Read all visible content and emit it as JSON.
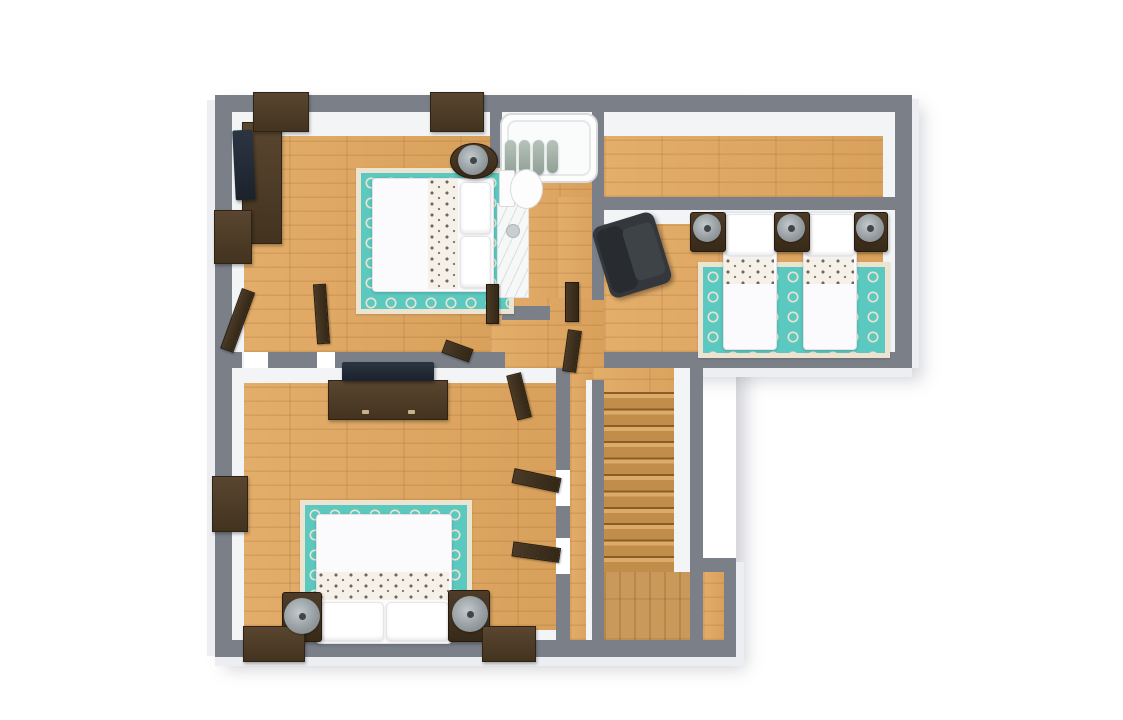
{
  "app": {
    "type": "3d-floor-plan-render",
    "view": "top-down",
    "background": "#ffffff",
    "visible_text": "none"
  },
  "palette": {
    "wall": "#7a7f88",
    "reveal": "#f3f4f6",
    "exterior": "#eceef1",
    "wood": "#e1a75f",
    "landingWood": "#c9995a",
    "stairEdge": "#8a5d28",
    "rugTeal": "#5cc9c0",
    "rugCream": "#ece4d0",
    "bedWhite": "#fbfbfd",
    "chairDark": "#34383d",
    "shadowCol": "rgba(125,130,140,0.35)"
  },
  "floor_plan": {
    "counts": {
      "bedrooms": 3,
      "bathrooms": 1,
      "beds": 4,
      "rugs": 3,
      "lamps": 6,
      "open_doors": 9,
      "stair_treads": 11
    },
    "rooms": [
      {
        "id": "bedroom-top-left",
        "type": "bedroom",
        "furniture": [
          "double-bed-bird-pattern-blanket",
          "teal-quatrefoil-rug",
          "media-console",
          "flat-tv",
          "wall-dresser",
          "wall-dresser",
          "round-nightstand-with-lamp",
          "side-cabinet",
          "open-door",
          "open-door"
        ]
      },
      {
        "id": "bathroom",
        "type": "bathroom",
        "furniture": [
          "bathtub",
          "shower-curtain",
          "toilet",
          "marble-vanity-sink",
          "open-door"
        ]
      },
      {
        "id": "hall-top-right",
        "type": "hallway",
        "furniture": []
      },
      {
        "id": "bedroom-twin",
        "type": "bedroom",
        "furniture": [
          "twin-bed-bird-pattern-blanket",
          "twin-bed-bird-pattern-blanket",
          "nightstand-with-lamp",
          "nightstand-with-lamp",
          "nightstand-with-lamp",
          "armchair",
          "teal-quatrefoil-rug"
        ]
      },
      {
        "id": "bedroom-master",
        "type": "bedroom",
        "furniture": [
          "double-bed-bird-pattern-blanket",
          "teal-quatrefoil-rug",
          "long-dresser",
          "flat-tv",
          "nightstand-with-lamp",
          "nightstand-with-lamp",
          "wall-cabinet",
          "wall-cabinet",
          "wall-cabinet",
          "open-door",
          "open-door"
        ]
      },
      {
        "id": "hallway-center",
        "type": "hallway",
        "furniture": [
          "open-door",
          "open-door",
          "open-door",
          "open-door",
          "open-door"
        ]
      },
      {
        "id": "staircase",
        "type": "stairs",
        "treads": 11,
        "landing": true,
        "direction": "descends-south"
      }
    ]
  }
}
